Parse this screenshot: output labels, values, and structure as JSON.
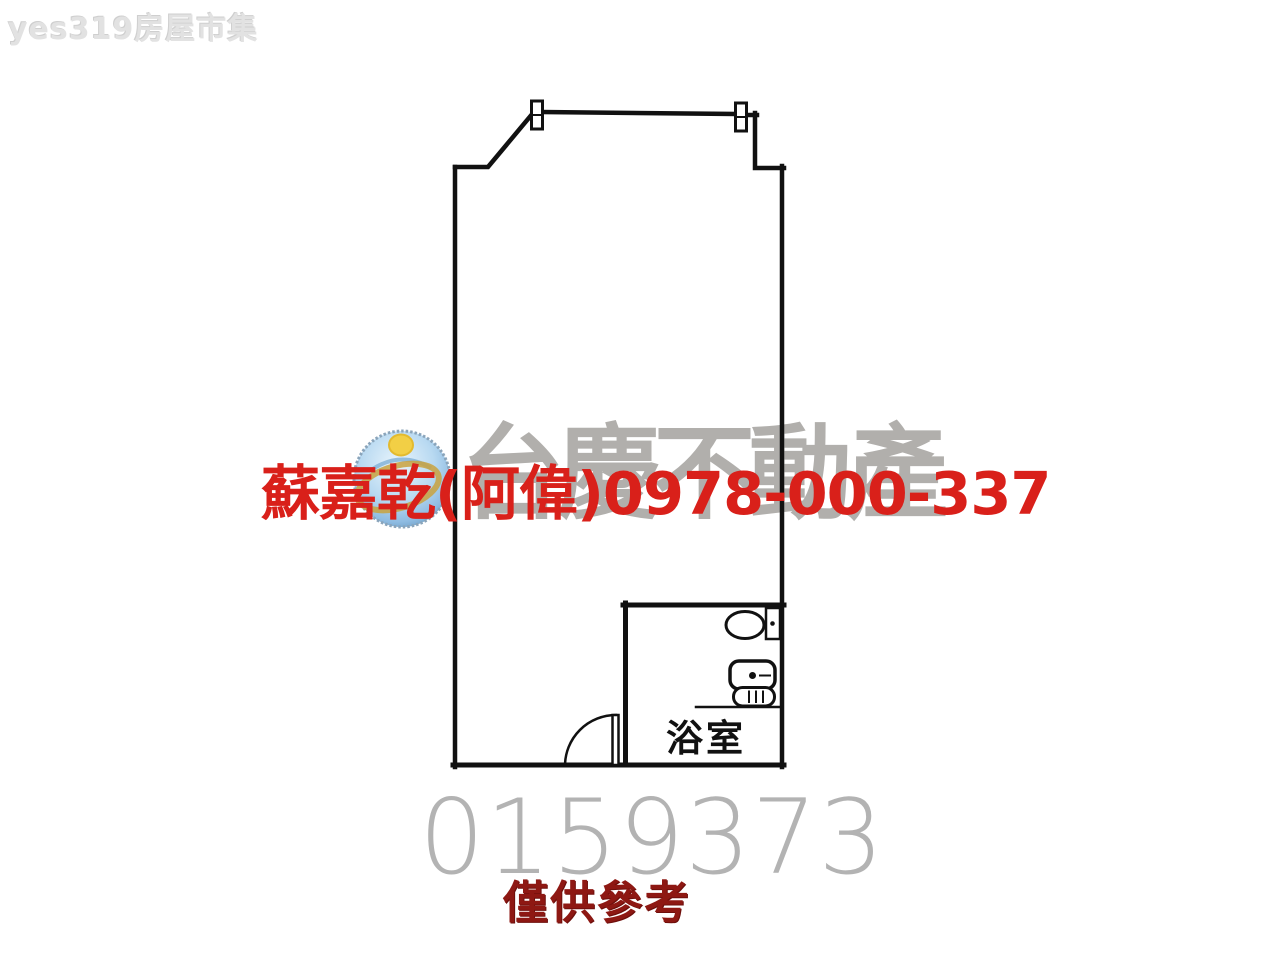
{
  "canvas": {
    "width": 1280,
    "height": 960,
    "background": "#ffffff"
  },
  "watermarks": {
    "site_logo_text": "yes319房屋市集",
    "brand_name": "台慶不動產",
    "agent_contact": "蘇嘉乾(阿偉)0978-000-337",
    "listing_number": "0159373",
    "disclaimer": "僅供參考"
  },
  "floorplan": {
    "bathroom_label": "浴室",
    "icons": [
      "window-icon",
      "window-icon",
      "door-swing-icon",
      "toilet-icon",
      "washbasin-icon",
      "bath-grille-icon"
    ]
  },
  "colors": {
    "agent_red": "#d9201a",
    "disclaimer_dark_red": "#8e1813",
    "brand_gray": "#b1afac",
    "serial_gray": "#b3b3b3",
    "site_mark_gray": "#e2e2e2",
    "plan_line_black": "#111111",
    "logo_blue_light": "#cfe7f8",
    "logo_blue_deep": "#6f9fc6",
    "logo_yellow": "#f2cf45",
    "logo_gold": "#c9a23e"
  }
}
